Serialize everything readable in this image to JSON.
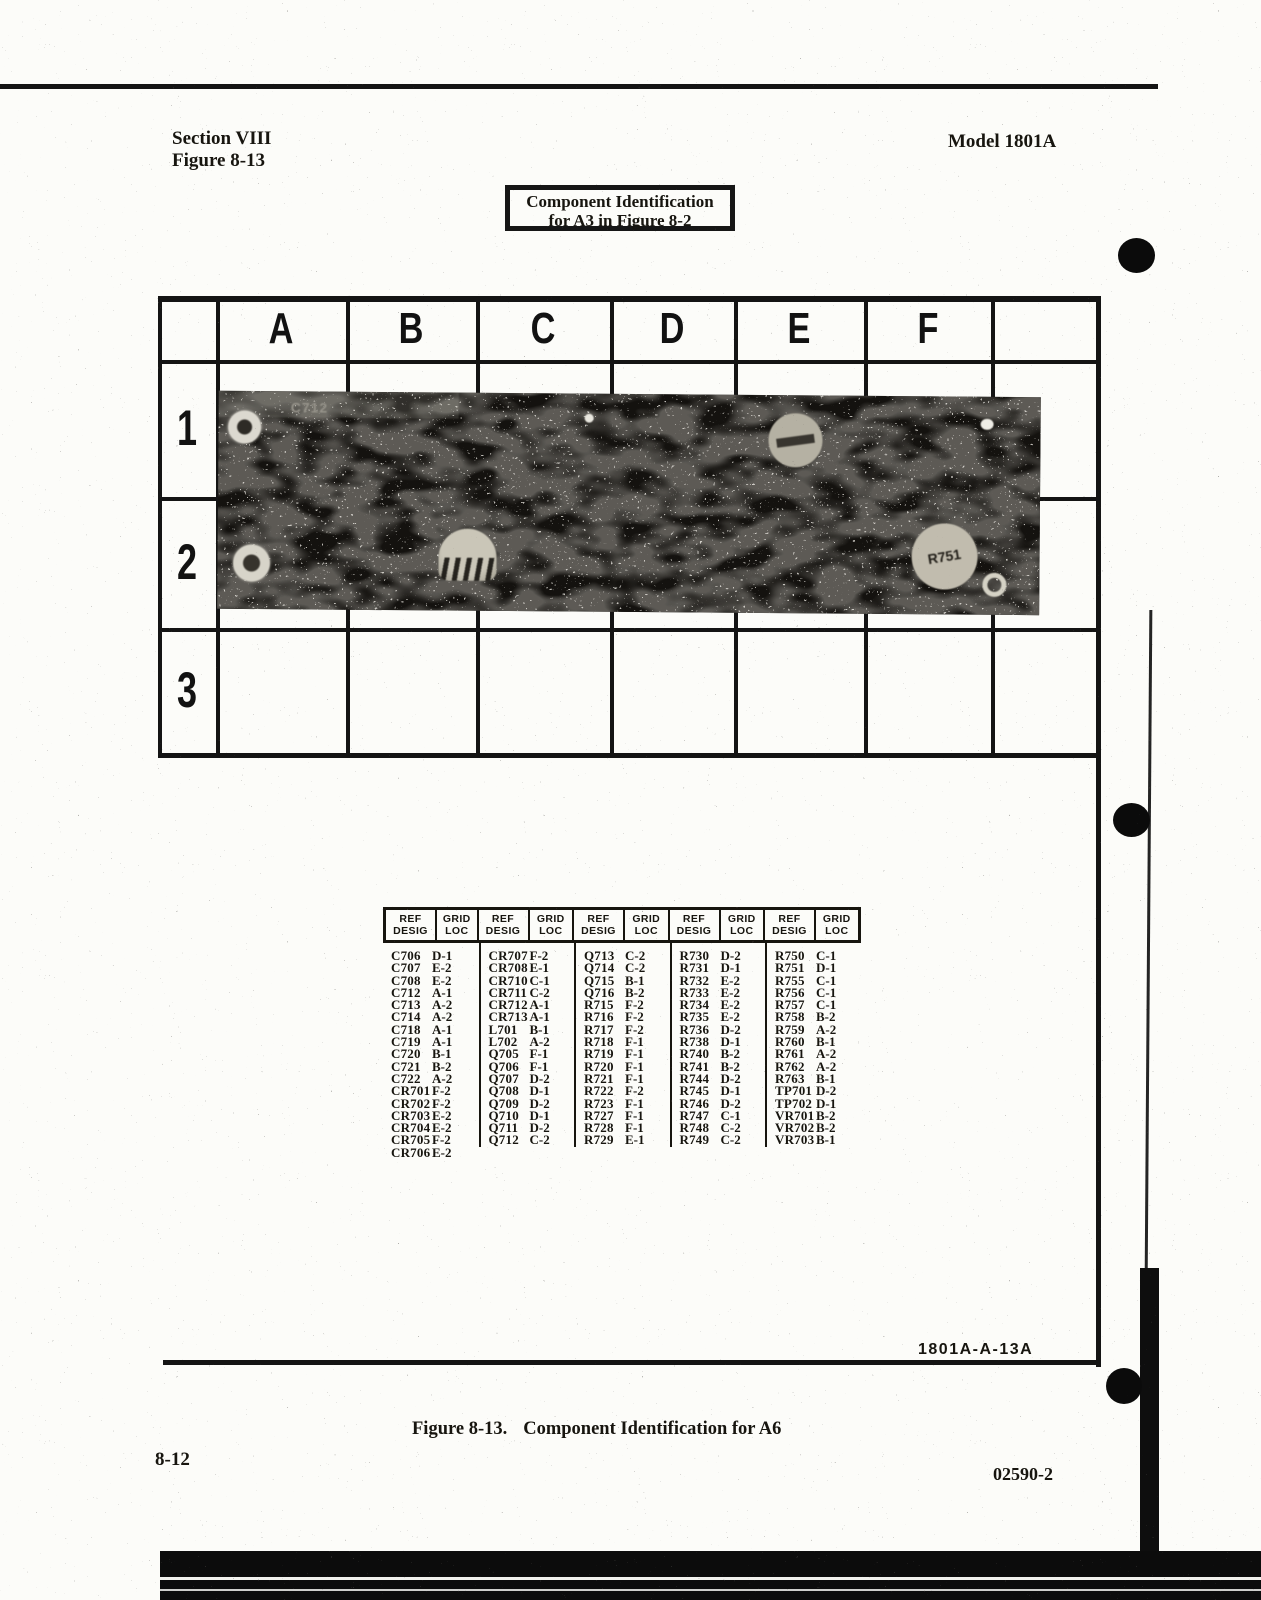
{
  "header": {
    "section": "Section VIII",
    "figure": "Figure 8-13",
    "model": "Model 1801A"
  },
  "title_box": {
    "line1": "Component Identification",
    "line2": "for A3 in Figure 8-2"
  },
  "grid": {
    "columns": [
      "A",
      "B",
      "C",
      "D",
      "E",
      "F"
    ],
    "rows": [
      "1",
      "2",
      "3"
    ]
  },
  "photo": {
    "board_label": "C712",
    "component_label": "R751"
  },
  "table": {
    "headers": {
      "ref": [
        "REF",
        "DESIG"
      ],
      "loc": [
        "GRID",
        "LOC"
      ]
    },
    "groups": [
      [
        [
          "C706",
          "D-1"
        ],
        [
          "C707",
          "E-2"
        ],
        [
          "C708",
          "E-2"
        ],
        [
          "C712",
          "A-1"
        ],
        [
          "C713",
          "A-2"
        ],
        [
          "C714",
          "A-2"
        ],
        [
          "C718",
          "A-1"
        ],
        [
          "C719",
          "A-1"
        ],
        [
          "C720",
          "B-1"
        ],
        [
          "C721",
          "B-2"
        ],
        [
          "C722",
          "A-2"
        ],
        [
          "CR701",
          "F-2"
        ],
        [
          "CR702",
          "F-2"
        ],
        [
          "CR703",
          "E-2"
        ],
        [
          "CR704",
          "E-2"
        ],
        [
          "CR705",
          "F-2"
        ],
        [
          "CR706",
          "E-2"
        ]
      ],
      [
        [
          "CR707",
          "F-2"
        ],
        [
          "CR708",
          "E-1"
        ],
        [
          "CR710",
          "C-1"
        ],
        [
          "CR711",
          "C-2"
        ],
        [
          "CR712",
          "A-1"
        ],
        [
          "CR713",
          "A-1"
        ],
        [
          "L701",
          "B-1"
        ],
        [
          "L702",
          "A-2"
        ],
        [
          "Q705",
          "F-1"
        ],
        [
          "Q706",
          "F-1"
        ],
        [
          "Q707",
          "D-2"
        ],
        [
          "Q708",
          "D-1"
        ],
        [
          "Q709",
          "D-2"
        ],
        [
          "Q710",
          "D-1"
        ],
        [
          "Q711",
          "D-2"
        ],
        [
          "Q712",
          "C-2"
        ]
      ],
      [
        [
          "Q713",
          "C-2"
        ],
        [
          "Q714",
          "C-2"
        ],
        [
          "Q715",
          "B-1"
        ],
        [
          "Q716",
          "B-2"
        ],
        [
          "R715",
          "F-2"
        ],
        [
          "R716",
          "F-2"
        ],
        [
          "R717",
          "F-2"
        ],
        [
          "R718",
          "F-1"
        ],
        [
          "R719",
          "F-1"
        ],
        [
          "R720",
          "F-1"
        ],
        [
          "R721",
          "F-1"
        ],
        [
          "R722",
          "F-2"
        ],
        [
          "R723",
          "F-1"
        ],
        [
          "R727",
          "F-1"
        ],
        [
          "R728",
          "F-1"
        ],
        [
          "R729",
          "E-1"
        ]
      ],
      [
        [
          "R730",
          "D-2"
        ],
        [
          "R731",
          "D-1"
        ],
        [
          "R732",
          "E-2"
        ],
        [
          "R733",
          "E-2"
        ],
        [
          "R734",
          "E-2"
        ],
        [
          "R735",
          "E-2"
        ],
        [
          "R736",
          "D-2"
        ],
        [
          "R738",
          "D-1"
        ],
        [
          "R740",
          "B-2"
        ],
        [
          "R741",
          "B-2"
        ],
        [
          "R744",
          "D-2"
        ],
        [
          "R745",
          "D-1"
        ],
        [
          "R746",
          "D-2"
        ],
        [
          "R747",
          "C-1"
        ],
        [
          "R748",
          "C-2"
        ],
        [
          "R749",
          "C-2"
        ]
      ],
      [
        [
          "R750",
          "C-1"
        ],
        [
          "R751",
          "D-1"
        ],
        [
          "R755",
          "C-1"
        ],
        [
          "R756",
          "C-1"
        ],
        [
          "R757",
          "C-1"
        ],
        [
          "R758",
          "B-2"
        ],
        [
          "R759",
          "A-2"
        ],
        [
          "R760",
          "B-1"
        ],
        [
          "R761",
          "A-2"
        ],
        [
          "R762",
          "A-2"
        ],
        [
          "R763",
          "B-1"
        ],
        [
          "TP701",
          "D-2"
        ],
        [
          "TP702",
          "D-1"
        ],
        [
          "VR701",
          "B-2"
        ],
        [
          "VR702",
          "B-2"
        ],
        [
          "VR703",
          "B-1"
        ]
      ]
    ]
  },
  "footer": {
    "figure_id": "1801A-A-13A",
    "caption_figure": "Figure 8-13.",
    "caption_text": "Component Identification for A6",
    "page_number": "8-12",
    "doc_number": "02590-2"
  }
}
